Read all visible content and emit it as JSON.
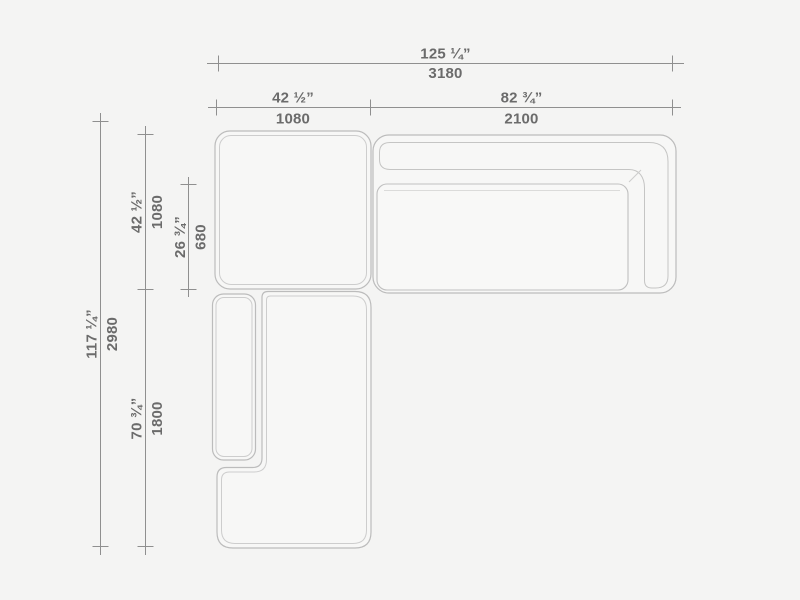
{
  "drawing": {
    "type": "furniture-plan-top-view",
    "subject": "sectional sofa with chaise",
    "colors": {
      "background": "#f4f4f3",
      "module_fill": "#f7f7f6",
      "outline": "#bcbcbc",
      "inner_outline": "#cdcdcd",
      "dimension_line": "#8f8f8f",
      "text": "#6b6b6b"
    }
  },
  "dims": {
    "top_overall": {
      "in": "125 ¼”",
      "mm": "3180"
    },
    "top_left": {
      "in": "42 ½”",
      "mm": "1080"
    },
    "top_right": {
      "in": "82 ¾”",
      "mm": "2100"
    },
    "side_overall": {
      "in": "117 ¼”",
      "mm": "2980"
    },
    "side_corner": {
      "in": "42 ½”",
      "mm": "1080"
    },
    "seat_depth": {
      "in": "26 ¾”",
      "mm": "680"
    },
    "side_chaise": {
      "in": "70 ¾”",
      "mm": "1800"
    }
  }
}
